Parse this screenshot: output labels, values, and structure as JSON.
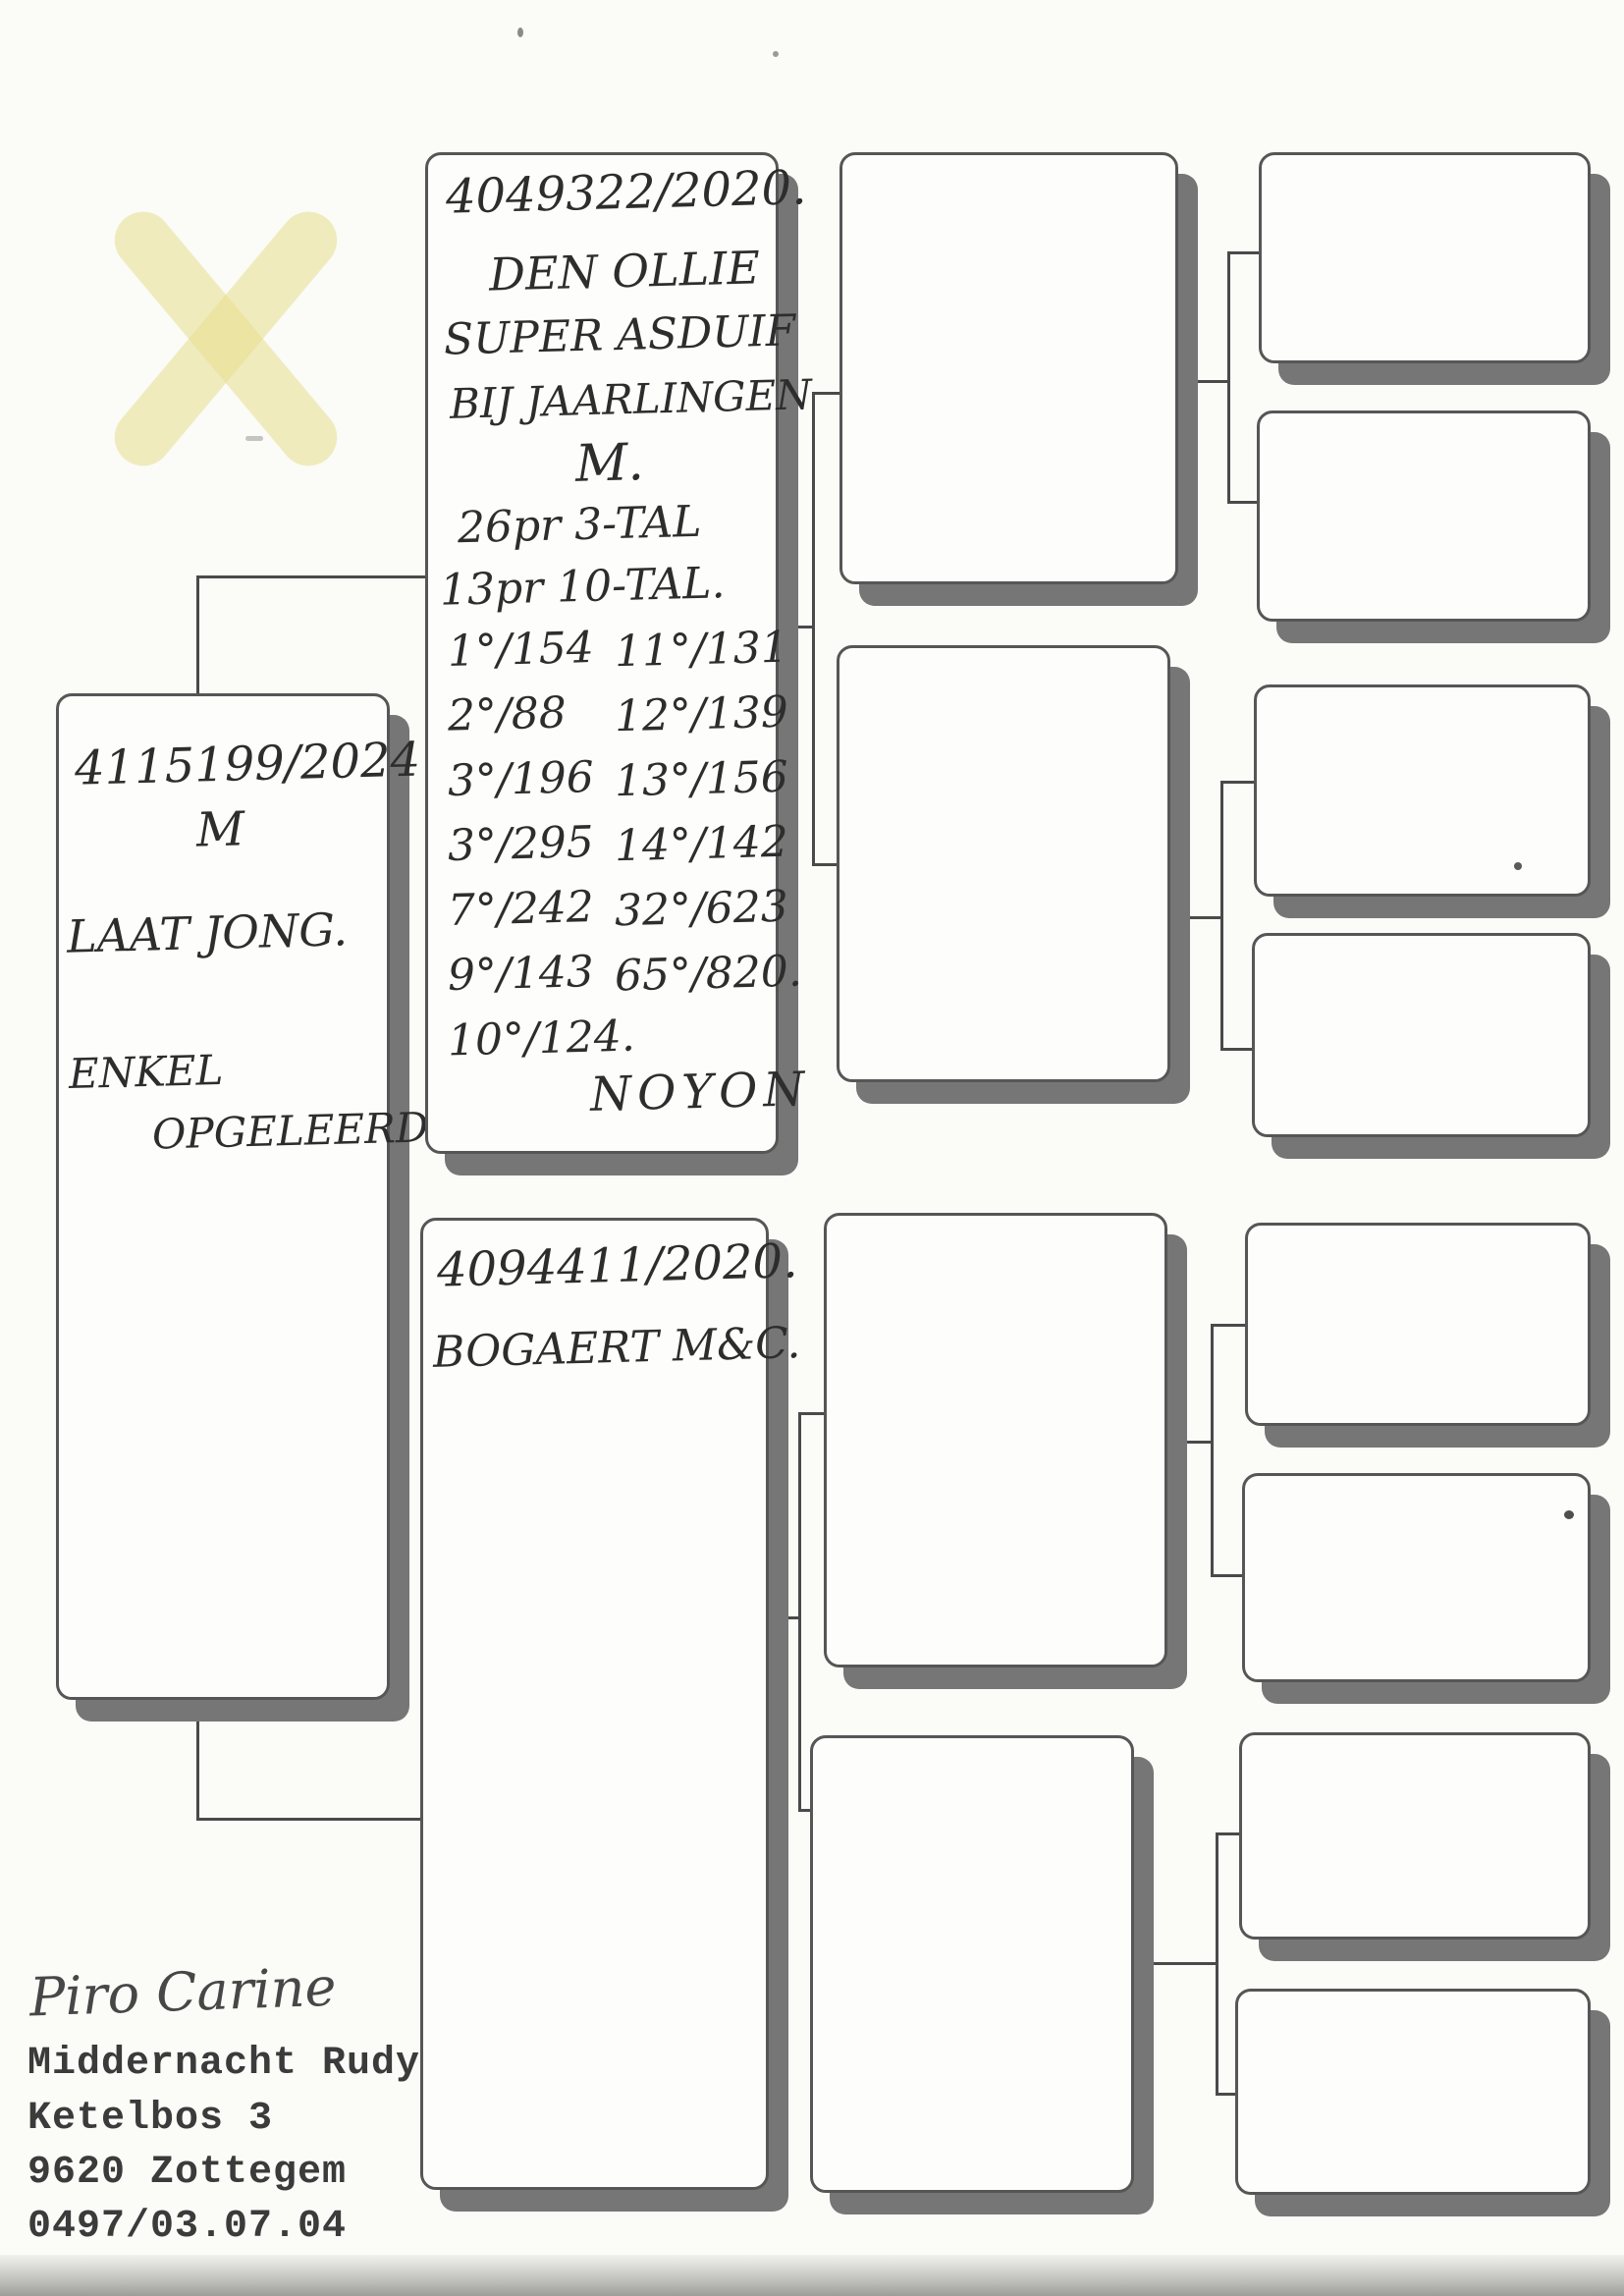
{
  "document": {
    "child": {
      "ring": "4115199/2024.",
      "sex": "M",
      "note1": "LAAT JONG.",
      "note2": "ENKEL",
      "note3": "OPGELEERD"
    },
    "sire": {
      "ring": "4049322/2020.",
      "name": "DEN OLLIE",
      "subtitle1": "SUPER ASDUIF",
      "subtitle2": "BIJ JAARLINGEN",
      "sex": "M.",
      "prizes_summary1": "26pr 3-TAL",
      "prizes_summary2": "13pr 10-TAL.",
      "results": [
        {
          "left": "1°/154",
          "right": "11°/131"
        },
        {
          "left": "2°/88",
          "right": "12°/139"
        },
        {
          "left": "3°/196",
          "right": "13°/156"
        },
        {
          "left": "3°/295",
          "right": "14°/142"
        },
        {
          "left": "7°/242",
          "right": "32°/623"
        },
        {
          "left": "9°/143",
          "right": "65°/820."
        },
        {
          "left": "10°/124.",
          "right": ""
        }
      ],
      "race_name": "NOYON"
    },
    "dam": {
      "ring": "4094411/2020.",
      "name": "BOGAERT M&C."
    },
    "footer": {
      "signature": "Piro Carine",
      "owner_name": "Middernacht Rudy",
      "address_line1": "Ketelbos 3",
      "address_line2": "9620 Zottegem",
      "phone": "0497/03.07.04"
    },
    "colors": {
      "ink": "#2d2d2d",
      "typed_ink": "#3b3b3b",
      "box_shadow": "#767676",
      "connector": "#4a4a4a",
      "highlight": "#e8de8c"
    }
  }
}
